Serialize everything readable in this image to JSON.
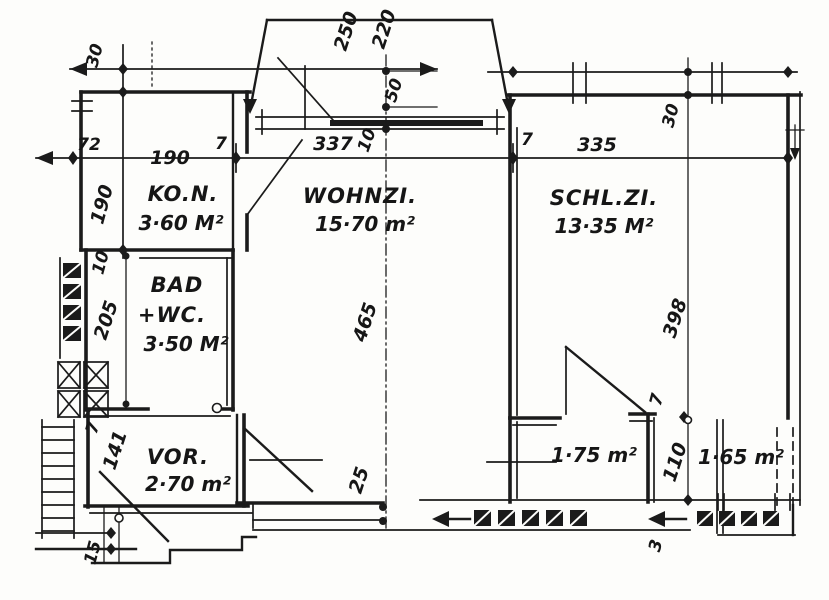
{
  "drawing": {
    "kind": "apartment-floor-plan-scan",
    "ink_color": "#1b1b1b",
    "paper_color": "#fdfdfb",
    "rooms": {
      "kon": {
        "name": "KO.N.",
        "area": "3·60 M²"
      },
      "wohnzi": {
        "name": "WOHNZI.",
        "area": "15·70 m²"
      },
      "schlzi": {
        "name": "SCHL.ZI.",
        "area": "13·35 M²"
      },
      "bad": {
        "name": "BAD",
        "name2": "+WC.",
        "area": "3·50 M²"
      },
      "vor": {
        "name": "VOR.",
        "area": "2·70 m²"
      },
      "closet": {
        "area": "1·75 m²"
      },
      "niche": {
        "area": "1·65 m²"
      }
    },
    "dims": {
      "top_left_30": "30",
      "balcony_250": "250",
      "balcony_220": "220",
      "door_50": "50",
      "left_72": "72",
      "kon_width": "190",
      "kon_height": "190",
      "wall_a_7": "7",
      "wohnzi_width": "337",
      "offset_10": "10",
      "wall_b_7": "7",
      "schlzi_width": "335",
      "right_30": "30",
      "wohnzi_depth": "465",
      "schlzi_depth": "398",
      "bad_offset_10": "10",
      "bad_height": "205",
      "vor_wall_7": "7",
      "vor_height": "141",
      "entry_25": "25",
      "door_wall_7": "7",
      "niche_height": "110",
      "bottom_15": "15",
      "corridor_3": "3"
    }
  }
}
